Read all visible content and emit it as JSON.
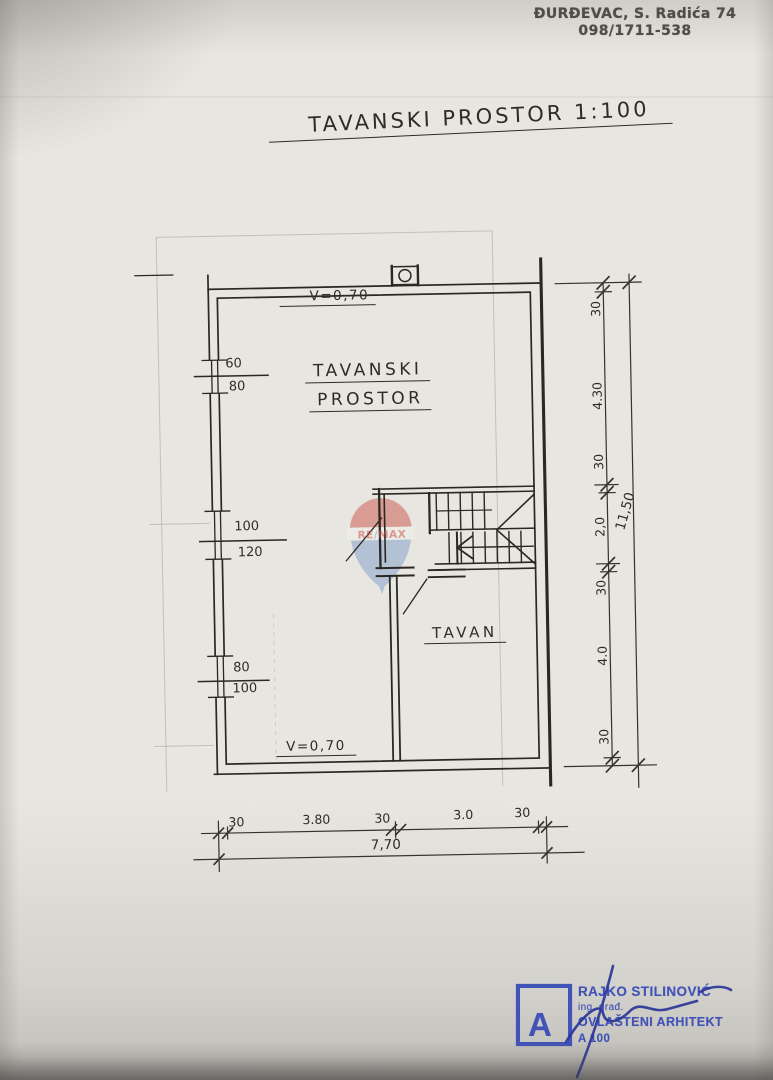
{
  "header": {
    "address": "ĐURĐEVAC, S. Radića 74",
    "phone": "098/1711-538"
  },
  "title": "TAVANSKI PROSTOR 1:100",
  "plan": {
    "room1_line1": "TAVANSKI",
    "room1_line2": "PROSTOR",
    "room2": "TAVAN",
    "v_top": "V=0,70",
    "v_bottom": "V=0,70",
    "windows": [
      {
        "num": "60",
        "den": "80"
      },
      {
        "num": "100",
        "den": "120"
      },
      {
        "num": "80",
        "den": "100"
      }
    ]
  },
  "dimensions": {
    "right_chain": [
      "30",
      "4.30",
      "30",
      "2,0",
      "30",
      "4.0",
      "30"
    ],
    "right_overall": "11,50",
    "bottom_chain": [
      "30",
      "3.80",
      "30",
      "3.0",
      "30"
    ],
    "bottom_overall": "7,70"
  },
  "watermark": {
    "re": "RE",
    "slash": "/",
    "max": "MAX"
  },
  "stamp": {
    "letter": "A",
    "name": "RAJKO STILINOVIĆ",
    "degree": "ing. građ.",
    "role": "OVLAŠTENI ARHITEKT",
    "license": "A 100"
  },
  "colors": {
    "ink": "#2a2823",
    "stamp_blue": "#4253b8",
    "remax_red": "#c9544c",
    "remax_blue": "#7d9ec9"
  }
}
